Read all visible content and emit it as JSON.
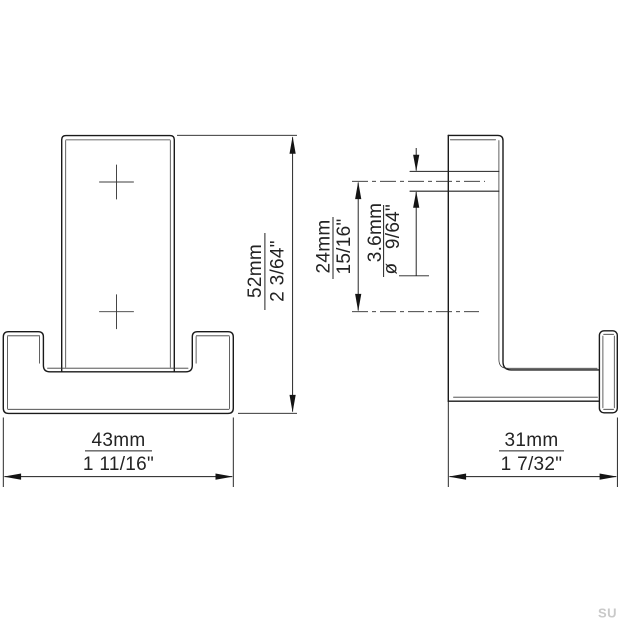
{
  "drawing": {
    "type": "technical-dimension-drawing",
    "subject": "double wall hook, front and side views",
    "background": "#ffffff",
    "line_color": "#1a1a1a",
    "dimensions": {
      "height": {
        "mm": "52mm",
        "inch": "2 3/64\""
      },
      "width": {
        "mm": "43mm",
        "inch": "1 11/16\""
      },
      "depth": {
        "mm": "31mm",
        "inch": "1 7/32\""
      },
      "hole_spacing": {
        "mm": "24mm",
        "inch": "15/16\""
      },
      "hole_diameter": {
        "symbol": "ø",
        "mm": "3.6mm",
        "inch": "9/64\""
      }
    },
    "watermark": "SU"
  }
}
